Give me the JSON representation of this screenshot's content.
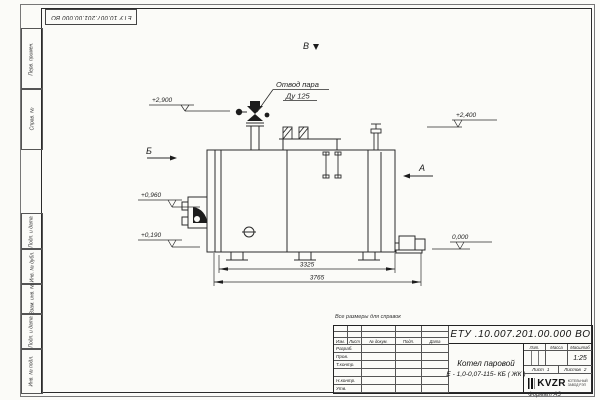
{
  "frame": {
    "top_stamp": "ЕТУ 10.007.201.00.000  ВО",
    "reference_note": "Все размеры для справок",
    "format_label": "Формат А3",
    "side_labels": {
      "perv": "Перв. примен.",
      "sprav": "Справ. №",
      "podp1": "Подп. и дата",
      "inv_dubl": "Инв. № дубл.",
      "vzam": "Взам. инв. №",
      "podp2": "Подп. и дата",
      "inv_podl": "Инв. № подл."
    }
  },
  "drawing": {
    "callout_line1": "Отвод пара",
    "callout_line2": "Ду 125",
    "view_top": "В",
    "view_left": "Б",
    "view_right": "А",
    "elev_2900": "+2,900",
    "elev_2400": "+2,400",
    "elev_0960": "+0,960",
    "elev_0190": "+0,190",
    "elev_0000": "0,000",
    "dim_inner": "3325",
    "dim_outer": "3765"
  },
  "title_block": {
    "doc_number": "ЕТУ .10.007.201.00.000  ВО",
    "product_name": "Котел паровой",
    "product_type": "Е - 1,0-0,07-115- КБ ( ЖК )",
    "col_izm": "Изм.",
    "col_list": "Лист",
    "col_docum": "№ докум.",
    "col_podp": "Подп.",
    "col_data": "Дата",
    "row_razrab": "Разраб.",
    "row_prov": "Пров.",
    "row_tkontr": "Т.контр.",
    "row_nkontr": "Н.контр.",
    "row_utv": "Утв.",
    "lit_label": "Лит.",
    "massa_label": "Масса",
    "masshtab_label": "Масштаб",
    "scale_value": "1:25",
    "sheet_label": "Лист",
    "sheet_value": "1",
    "sheets_label": "Листов",
    "sheets_value": "2",
    "logo_name": "KVZR",
    "logo_line1": "КОТЕЛЬНЫЙ",
    "logo_line2": "ЗАВОД РЭП"
  }
}
